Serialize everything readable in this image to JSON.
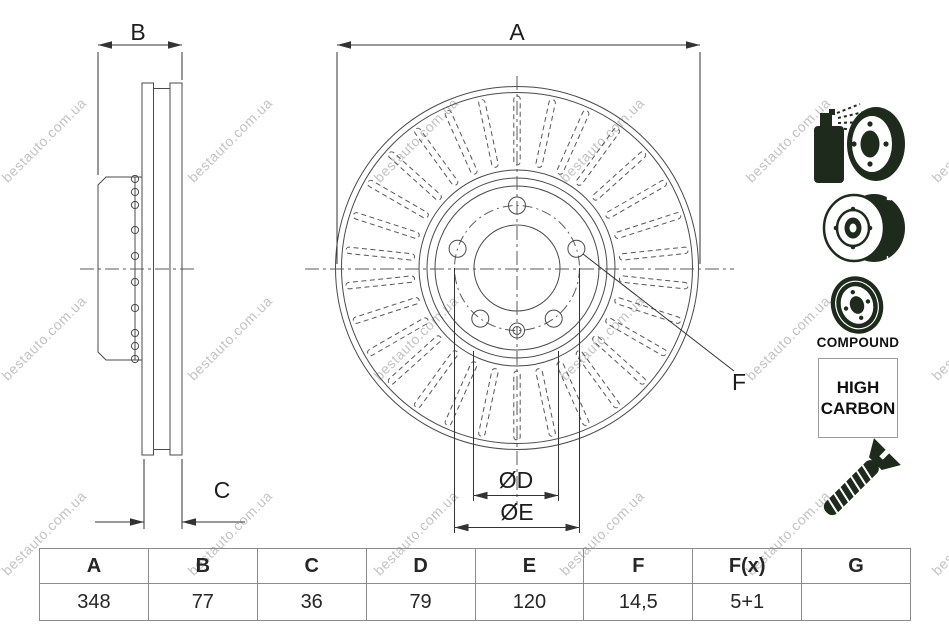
{
  "watermark": {
    "text": "bestauto.com.ua"
  },
  "labels": {
    "a": "A",
    "b": "B",
    "c": "C",
    "d": "ØD",
    "e": "ØE",
    "f": "F"
  },
  "badges": {
    "compound": "COMPOUND",
    "high_carbon_line1": "HIGH",
    "high_carbon_line2": "CARBON"
  },
  "table": {
    "headers": [
      "A",
      "B",
      "C",
      "D",
      "E",
      "F",
      "F(x)",
      "G"
    ],
    "values": [
      "348",
      "77",
      "36",
      "79",
      "120",
      "14,5",
      "5+1",
      ""
    ]
  }
}
